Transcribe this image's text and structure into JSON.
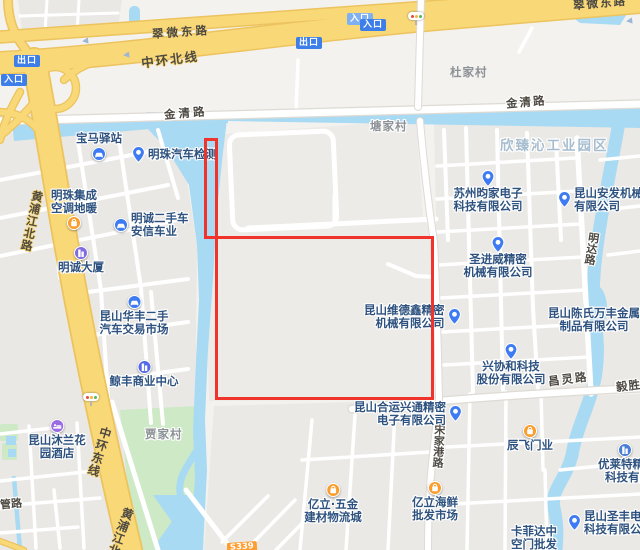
{
  "roads": {
    "cuiwei_east_left": "翠微东路",
    "cuiwei_east_right": "翠微东路",
    "zhonghuan_north": "中环北线",
    "jinqing_left": "金清路",
    "jinqing_right": "金清路",
    "huangpu_north": "黄浦江北路",
    "zhonghuan_east": "中环东线",
    "huangpu_south": "黄浦江北路",
    "mingda": "明达路",
    "changling": "昌灵路",
    "yisheng": "毅胜路",
    "songjiagang": "宋家港路",
    "guan": "光管路",
    "s339": "S339"
  },
  "badges": {
    "exit": "出口",
    "entrance": "入口"
  },
  "villages": {
    "du": "杜家村",
    "tang": "塘家村",
    "jia": "贾家村"
  },
  "areas": {
    "industrial_park": "欣臻沁工业园区"
  },
  "colors": {
    "water": "#a8daf3",
    "highway_yellow": "#f9d877",
    "annotation_red": "#f1342b",
    "poi_blue": "#3e7bf2",
    "poi_orange": "#f99d2d",
    "poi_purple": "#9a6ce3",
    "poi_indigo": "#5569e8"
  },
  "pois": [
    {
      "line1": "宝马驿站",
      "icon": "car-icon"
    },
    {
      "line1": "明珠汽车检测",
      "icon": "location-pin-icon"
    },
    {
      "line1": "明珠集成",
      "line2": "空调地暖",
      "icon": "shop-icon"
    },
    {
      "line1": "明诚二手车",
      "line2": "安信车业",
      "icon": "car-icon"
    },
    {
      "line1": "明诚大厦",
      "icon": "building-icon"
    },
    {
      "line1": "昆山华丰二手",
      "line2": "汽车交易市场",
      "icon": "car-icon"
    },
    {
      "line1": "鲸丰商业中心",
      "icon": "building-icon"
    },
    {
      "line1": "昆山沐兰花",
      "line2": "园酒店",
      "icon": "hotel-icon"
    },
    {
      "line1": "苏州昀家电子",
      "line2": "科技有限公司",
      "icon": "location-pin-icon"
    },
    {
      "line1": "昆山安发机械",
      "line2": "有限公司",
      "icon": "location-pin-icon"
    },
    {
      "line1": "圣进威精密",
      "line2": "机械有限公司",
      "icon": "location-pin-icon"
    },
    {
      "line1": "昆山维德鑫精密",
      "line2": "机械有限公司",
      "icon": "location-pin-icon"
    },
    {
      "line1": "昆山陈氏万丰金属",
      "line2": "制品有限公司",
      "icon": "none"
    },
    {
      "line1": "兴协和科技",
      "line2": "股份有限公司",
      "icon": "location-pin-icon"
    },
    {
      "line1": "昆山合运兴通精密",
      "line2": "电子有限公司",
      "icon": "location-pin-icon"
    },
    {
      "line1": "辰飞门业",
      "icon": "shop-icon"
    },
    {
      "line1": "优莱特精密",
      "line2": "科技有限公司",
      "icon": "company-icon"
    },
    {
      "line1": "昆山圣丰电子",
      "line2": "科技有限公司",
      "icon": "location-pin-icon"
    },
    {
      "line1": "卡菲达中",
      "line2": "空门批发",
      "icon": "none"
    },
    {
      "line1": "亿立·五金",
      "line2": "建材物流城",
      "icon": "shop-icon"
    },
    {
      "line1": "亿立海鲜",
      "line2": "批发市场",
      "icon": "shop-icon"
    }
  ]
}
